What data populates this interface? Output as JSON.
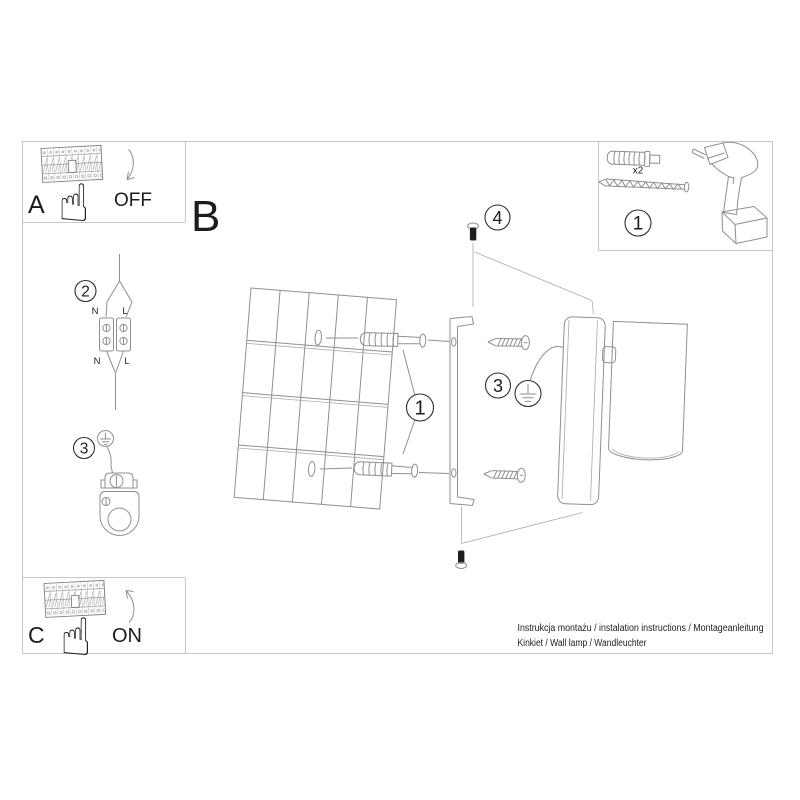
{
  "sheet": {
    "sections": {
      "a": {
        "label": "A",
        "state": "OFF"
      },
      "b": {
        "label": "B"
      },
      "c": {
        "label": "C",
        "state": "ON"
      }
    },
    "tools": {
      "step": "1",
      "plug_quantity": "x2"
    },
    "steps": {
      "drill": "1",
      "connect": "2",
      "ground_wire": "3",
      "ground_lamp": "3",
      "fix": "4"
    },
    "terminals": {
      "top_n": "N",
      "top_l": "L",
      "bottom_n": "N",
      "bottom_l": "L"
    },
    "footer": {
      "line1": "Instrukcja montażu / instalation instructions / Montageanleitung",
      "line2": "Kinkiet / Wall lamp / Wandleuchter"
    },
    "icons": {
      "hand": "☝"
    }
  }
}
